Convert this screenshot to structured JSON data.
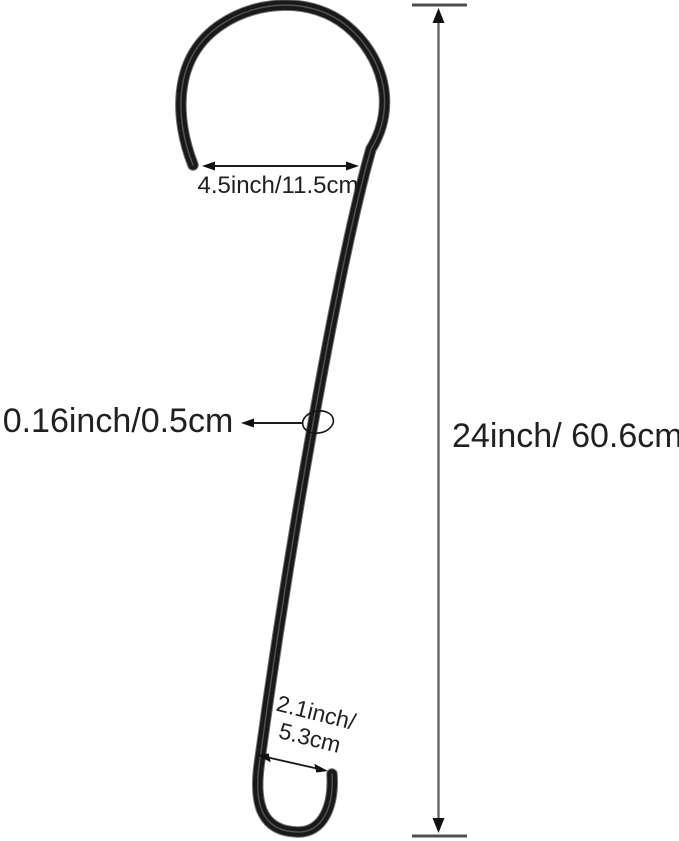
{
  "figure": {
    "type": "product-dimension-diagram",
    "subject": "long extension hanging hook",
    "background_color": "#ffffff",
    "hook_color": "#191919",
    "dimension_line_color": "#1c1c1c",
    "length_line_color": "#696969",
    "text_color": "#212121"
  },
  "annotations": {
    "hook_opening": "4.5inch/11.5cm",
    "wire_thickness": "0.16inch/0.5cm",
    "overall_length": "24inch/ 60.6cm",
    "bottom_hook_line1": "2.1inch/",
    "bottom_hook_line2": "5.3cm"
  },
  "icons": {
    "top_width_arrow": "double-headed-horizontal-arrow",
    "thickness_arrow": "left-pointing-arrow-with-circle-callout",
    "overall_length_arrow": "double-headed-vertical-arrow-with-end-ticks",
    "bottom_hook_arrow": "double-headed-diagonal-arrow"
  }
}
